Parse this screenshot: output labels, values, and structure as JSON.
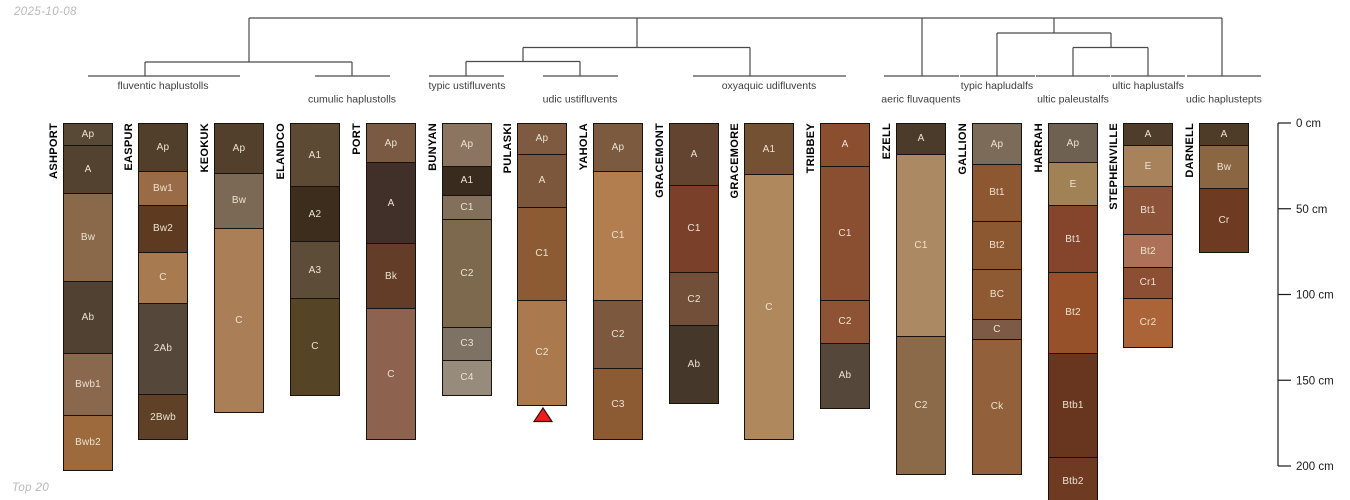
{
  "meta": {
    "date_label": "2025-10-08",
    "footer_label": "Top 20"
  },
  "colors": {
    "line": "#4a4a4a",
    "axis_text": "#1a1a1a",
    "group_label_text": "#3d3d3d",
    "horizon_label_text": "#ece3d2",
    "series_label_text": "#000000",
    "horizon_border": "#17120c",
    "marker_fill": "#ee1c1c",
    "marker_stroke": "#3a0a0a",
    "muted_text": "#b9b9b9"
  },
  "chart_data": {
    "type": "soil-profile-columns-with-taxonomy-dendrogram",
    "depth_axis": {
      "unit": "cm",
      "ticks": [
        0,
        50,
        100,
        150,
        200
      ],
      "tick_labels": [
        "0 cm",
        "50 cm",
        "100 cm",
        "150 cm",
        "200 cm"
      ],
      "axis_x": 1278,
      "tick_len": 13,
      "label_x": 1296,
      "y_at_0cm": 123,
      "px_per_cm": 1.715
    },
    "groups": [
      {
        "label": "fluventic haplustolls",
        "x": 163,
        "baseline_y": 89,
        "members": [
          "ASHPORT",
          "EASPUR",
          "KEOKUK"
        ]
      },
      {
        "label": "cumulic haplustolls",
        "x": 352,
        "baseline_y": 102.5,
        "members": [
          "ELANDCO",
          "PORT"
        ]
      },
      {
        "label": "typic ustifluvents",
        "x": 467,
        "baseline_y": 89,
        "members": [
          "BUNYAN"
        ]
      },
      {
        "label": "udic ustifluvents",
        "x": 580,
        "baseline_y": 102.5,
        "members": [
          "PULASKI",
          "YAHOLA"
        ]
      },
      {
        "label": "oxyaquic udifluvents",
        "x": 769,
        "baseline_y": 89,
        "members": [
          "GRACEMONT",
          "GRACEMORE",
          "TRIBBEY"
        ]
      },
      {
        "label": "aeric fluvaquents",
        "x": 921,
        "baseline_y": 102.5,
        "members": [
          "EZELL"
        ]
      },
      {
        "label": "typic hapludalfs",
        "x": 997,
        "baseline_y": 89,
        "members": [
          "GALLION"
        ]
      },
      {
        "label": "ultic paleustalfs",
        "x": 1073,
        "baseline_y": 102.5,
        "members": [
          "HARRAH"
        ]
      },
      {
        "label": "ultic haplustalfs",
        "x": 1148,
        "baseline_y": 89,
        "members": [
          "STEPHENVILLE"
        ]
      },
      {
        "label": "udic haplustepts",
        "x": 1224,
        "baseline_y": 102.5,
        "members": [
          "DARNELL"
        ]
      }
    ],
    "dendrogram": {
      "horizontals": [
        [
          249,
          18,
          1222,
          18
        ],
        [
          145,
          62,
          352,
          62
        ],
        [
          523,
          47.5,
          750,
          47.5
        ],
        [
          466,
          61.5,
          580,
          61.5
        ],
        [
          997,
          33,
          1111,
          33
        ],
        [
          1073,
          47.5,
          1148,
          47.5
        ],
        [
          88,
          76,
          240,
          76
        ],
        [
          315,
          76,
          390,
          76
        ],
        [
          429,
          76,
          504,
          76
        ],
        [
          543,
          76,
          618,
          76
        ],
        [
          693,
          76,
          846,
          76
        ],
        [
          884,
          76,
          959,
          76
        ],
        [
          960,
          76,
          1035,
          76
        ],
        [
          1036,
          76,
          1110,
          76
        ],
        [
          1111,
          76,
          1185,
          76
        ],
        [
          1187,
          76,
          1261,
          76
        ]
      ],
      "verticals": [
        [
          249,
          18,
          62
        ],
        [
          637,
          18,
          47.5
        ],
        [
          922,
          18,
          76
        ],
        [
          1054,
          18,
          33
        ],
        [
          1222,
          18,
          76
        ],
        [
          145,
          62,
          76
        ],
        [
          352,
          62,
          76
        ],
        [
          523,
          47.5,
          61.5
        ],
        [
          750,
          47.5,
          76
        ],
        [
          466,
          61.5,
          76
        ],
        [
          580,
          61.5,
          76
        ],
        [
          997,
          33,
          76
        ],
        [
          1111,
          33,
          47.5
        ],
        [
          1073,
          47.5,
          76
        ],
        [
          1148,
          47.5,
          76
        ]
      ]
    },
    "marker": {
      "series": "PULASKI",
      "shape": "triangle-up",
      "x": 543,
      "apex_y": 408,
      "base_y": 421.5,
      "half_width": 9
    },
    "column_width": 50,
    "profiles": [
      {
        "name": "ASHPORT",
        "x": 88,
        "horizons": [
          {
            "label": "Ap",
            "top_cm": 0,
            "bottom_cm": 13,
            "color": "#584836"
          },
          {
            "label": "A",
            "top_cm": 13,
            "bottom_cm": 41,
            "color": "#53422f"
          },
          {
            "label": "Bw",
            "top_cm": 41,
            "bottom_cm": 92,
            "color": "#8a684a"
          },
          {
            "label": "Ab",
            "top_cm": 92,
            "bottom_cm": 134,
            "color": "#514132"
          },
          {
            "label": "Bwb1",
            "top_cm": 134,
            "bottom_cm": 170,
            "color": "#8a684e"
          },
          {
            "label": "Bwb2",
            "top_cm": 170,
            "bottom_cm": 203,
            "color": "#9c6a3c"
          }
        ]
      },
      {
        "name": "EASPUR",
        "x": 163,
        "horizons": [
          {
            "label": "Ap",
            "top_cm": 0,
            "bottom_cm": 28,
            "color": "#523f2b"
          },
          {
            "label": "Bw1",
            "top_cm": 28,
            "bottom_cm": 48,
            "color": "#996b46"
          },
          {
            "label": "Bw2",
            "top_cm": 48,
            "bottom_cm": 75,
            "color": "#5d3a20"
          },
          {
            "label": "C",
            "top_cm": 75,
            "bottom_cm": 105,
            "color": "#a87a50"
          },
          {
            "label": "2Ab",
            "top_cm": 105,
            "bottom_cm": 158,
            "color": "#55473a"
          },
          {
            "label": "2Bwb",
            "top_cm": 158,
            "bottom_cm": 185,
            "color": "#5e4126"
          }
        ]
      },
      {
        "name": "KEOKUK",
        "x": 239,
        "horizons": [
          {
            "label": "Ap",
            "top_cm": 0,
            "bottom_cm": 29,
            "color": "#52402c"
          },
          {
            "label": "Bw",
            "top_cm": 29,
            "bottom_cm": 61,
            "color": "#7c6955"
          },
          {
            "label": "C",
            "top_cm": 61,
            "bottom_cm": 169,
            "color": "#aa7f58"
          }
        ]
      },
      {
        "name": "ELANDCO",
        "x": 315,
        "horizons": [
          {
            "label": "A1",
            "top_cm": 0,
            "bottom_cm": 37,
            "color": "#5c4a34"
          },
          {
            "label": "A2",
            "top_cm": 37,
            "bottom_cm": 69,
            "color": "#3c2d1d"
          },
          {
            "label": "A3",
            "top_cm": 69,
            "bottom_cm": 102,
            "color": "#5d4c38"
          },
          {
            "label": "C",
            "top_cm": 102,
            "bottom_cm": 159,
            "color": "#554526"
          }
        ]
      },
      {
        "name": "PORT",
        "x": 391,
        "horizons": [
          {
            "label": "Ap",
            "top_cm": 0,
            "bottom_cm": 23,
            "color": "#7a5a42"
          },
          {
            "label": "A",
            "top_cm": 23,
            "bottom_cm": 70,
            "color": "#413029"
          },
          {
            "label": "Bk",
            "top_cm": 70,
            "bottom_cm": 108,
            "color": "#633d27"
          },
          {
            "label": "C",
            "top_cm": 108,
            "bottom_cm": 185,
            "color": "#8d6350"
          }
        ]
      },
      {
        "name": "BUNYAN",
        "x": 467,
        "horizons": [
          {
            "label": "Ap",
            "top_cm": 0,
            "bottom_cm": 25,
            "color": "#8b7561"
          },
          {
            "label": "A1",
            "top_cm": 25,
            "bottom_cm": 42,
            "color": "#392c1f"
          },
          {
            "label": "C1",
            "top_cm": 42,
            "bottom_cm": 56,
            "color": "#83705c"
          },
          {
            "label": "C2",
            "top_cm": 56,
            "bottom_cm": 119,
            "color": "#7d6a4e"
          },
          {
            "label": "C3",
            "top_cm": 119,
            "bottom_cm": 138,
            "color": "#7d7263"
          },
          {
            "label": "C4",
            "top_cm": 138,
            "bottom_cm": 159,
            "color": "#978b7b"
          }
        ]
      },
      {
        "name": "PULASKI",
        "x": 542,
        "horizons": [
          {
            "label": "Ap",
            "top_cm": 0,
            "bottom_cm": 18,
            "color": "#7d5a40"
          },
          {
            "label": "A",
            "top_cm": 18,
            "bottom_cm": 49,
            "color": "#7c573b"
          },
          {
            "label": "C1",
            "top_cm": 49,
            "bottom_cm": 103,
            "color": "#8c5b34"
          },
          {
            "label": "C2",
            "top_cm": 103,
            "bottom_cm": 165,
            "color": "#aa794d"
          }
        ]
      },
      {
        "name": "YAHOLA",
        "x": 618,
        "horizons": [
          {
            "label": "Ap",
            "top_cm": 0,
            "bottom_cm": 28,
            "color": "#7c5a40"
          },
          {
            "label": "C1",
            "top_cm": 28,
            "bottom_cm": 103,
            "color": "#b27d4f"
          },
          {
            "label": "C2",
            "top_cm": 103,
            "bottom_cm": 143,
            "color": "#7c583f"
          },
          {
            "label": "C3",
            "top_cm": 143,
            "bottom_cm": 185,
            "color": "#8c5b34"
          }
        ]
      },
      {
        "name": "GRACEMONT",
        "x": 694,
        "horizons": [
          {
            "label": "A",
            "top_cm": 0,
            "bottom_cm": 36,
            "color": "#634430"
          },
          {
            "label": "C1",
            "top_cm": 36,
            "bottom_cm": 87,
            "color": "#7b402a"
          },
          {
            "label": "C2",
            "top_cm": 87,
            "bottom_cm": 118,
            "color": "#724f39"
          },
          {
            "label": "Ab",
            "top_cm": 118,
            "bottom_cm": 164,
            "color": "#453729"
          }
        ]
      },
      {
        "name": "GRACEMORE",
        "x": 769,
        "horizons": [
          {
            "label": "A1",
            "top_cm": 0,
            "bottom_cm": 30,
            "color": "#745133"
          },
          {
            "label": "C",
            "top_cm": 30,
            "bottom_cm": 185,
            "color": "#af895d"
          }
        ]
      },
      {
        "name": "TRIBBEY",
        "x": 845,
        "horizons": [
          {
            "label": "A",
            "top_cm": 0,
            "bottom_cm": 25,
            "color": "#8b4f30"
          },
          {
            "label": "C1",
            "top_cm": 25,
            "bottom_cm": 103,
            "color": "#8a4f30"
          },
          {
            "label": "C2",
            "top_cm": 103,
            "bottom_cm": 128,
            "color": "#8d5334"
          },
          {
            "label": "Ab",
            "top_cm": 128,
            "bottom_cm": 167,
            "color": "#55483a"
          }
        ]
      },
      {
        "name": "EZELL",
        "x": 921,
        "horizons": [
          {
            "label": "A",
            "top_cm": 0,
            "bottom_cm": 18,
            "color": "#4a3b2b"
          },
          {
            "label": "C1",
            "top_cm": 18,
            "bottom_cm": 124,
            "color": "#ab8963"
          },
          {
            "label": "C2",
            "top_cm": 124,
            "bottom_cm": 205,
            "color": "#8a6a48"
          }
        ]
      },
      {
        "name": "GALLION",
        "x": 997,
        "horizons": [
          {
            "label": "Ap",
            "top_cm": 0,
            "bottom_cm": 24,
            "color": "#7d6b59"
          },
          {
            "label": "Bt1",
            "top_cm": 24,
            "bottom_cm": 57,
            "color": "#8d5831"
          },
          {
            "label": "Bt2",
            "top_cm": 57,
            "bottom_cm": 85,
            "color": "#8c5832"
          },
          {
            "label": "BC",
            "top_cm": 85,
            "bottom_cm": 114,
            "color": "#8e5a34"
          },
          {
            "label": "C",
            "top_cm": 114,
            "bottom_cm": 126,
            "color": "#7d5a45"
          },
          {
            "label": "Ck",
            "top_cm": 126,
            "bottom_cm": 205,
            "color": "#92603a"
          }
        ]
      },
      {
        "name": "HARRAH",
        "x": 1073,
        "horizons": [
          {
            "label": "Ap",
            "top_cm": 0,
            "bottom_cm": 23,
            "color": "#6f6152"
          },
          {
            "label": "E",
            "top_cm": 23,
            "bottom_cm": 48,
            "color": "#a08256"
          },
          {
            "label": "Bt1",
            "top_cm": 48,
            "bottom_cm": 87,
            "color": "#84452c"
          },
          {
            "label": "Bt2",
            "top_cm": 87,
            "bottom_cm": 134,
            "color": "#96512a"
          },
          {
            "label": "Btb1",
            "top_cm": 134,
            "bottom_cm": 195,
            "color": "#68351f"
          },
          {
            "label": "Btb2",
            "top_cm": 195,
            "bottom_cm": 223,
            "color": "#6e3a22"
          }
        ]
      },
      {
        "name": "STEPHENVILLE",
        "x": 1148,
        "horizons": [
          {
            "label": "A",
            "top_cm": 0,
            "bottom_cm": 13,
            "color": "#4f3d2b"
          },
          {
            "label": "E",
            "top_cm": 13,
            "bottom_cm": 37,
            "color": "#a8825a"
          },
          {
            "label": "Bt1",
            "top_cm": 37,
            "bottom_cm": 65,
            "color": "#8d5338"
          },
          {
            "label": "Bt2",
            "top_cm": 65,
            "bottom_cm": 84,
            "color": "#ac7156"
          },
          {
            "label": "Cr1",
            "top_cm": 84,
            "bottom_cm": 102,
            "color": "#8c4f33"
          },
          {
            "label": "Cr2",
            "top_cm": 102,
            "bottom_cm": 131,
            "color": "#aa6437"
          }
        ]
      },
      {
        "name": "DARNELL",
        "x": 1224,
        "horizons": [
          {
            "label": "A",
            "top_cm": 0,
            "bottom_cm": 13,
            "color": "#4e3c28"
          },
          {
            "label": "Bw",
            "top_cm": 13,
            "bottom_cm": 38,
            "color": "#8a6642"
          },
          {
            "label": "Cr",
            "top_cm": 38,
            "bottom_cm": 76,
            "color": "#6e3a22"
          }
        ]
      }
    ]
  }
}
